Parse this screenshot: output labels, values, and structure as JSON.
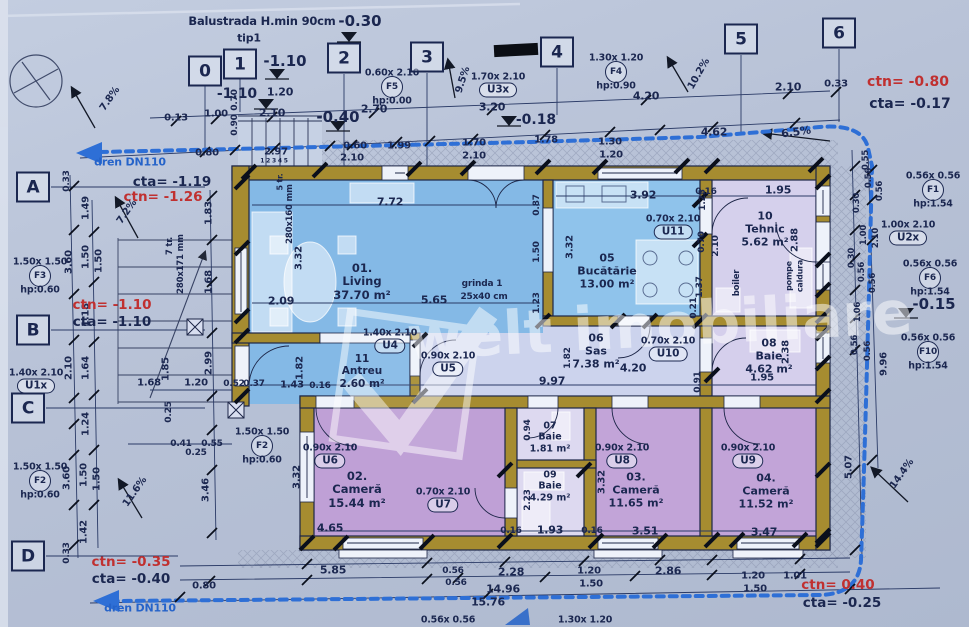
{
  "palette": {
    "ink": "#1b2750",
    "red": "#c03030",
    "blue": "#2563c9"
  },
  "watermark": {
    "brand": "welt imobiliare"
  },
  "grid": {
    "cols": [
      {
        "n": "0",
        "x": 205,
        "y": 71
      },
      {
        "n": "1",
        "x": 240,
        "y": 64
      },
      {
        "n": "2",
        "x": 344,
        "y": 58
      },
      {
        "n": "3",
        "x": 427,
        "y": 57
      },
      {
        "n": "4",
        "x": 557,
        "y": 52
      },
      {
        "n": "5",
        "x": 741,
        "y": 39
      },
      {
        "n": "6",
        "x": 839,
        "y": 33
      }
    ],
    "rows": [
      {
        "n": "A",
        "x": 33,
        "y": 187
      },
      {
        "n": "B",
        "x": 33,
        "y": 330
      },
      {
        "n": "C",
        "x": 28,
        "y": 408
      },
      {
        "n": "D",
        "x": 28,
        "y": 556
      }
    ]
  },
  "rooms": [
    {
      "num": "01.",
      "name": "Living",
      "area": "37.70 m²",
      "cx": 362,
      "cy": 281,
      "s": 11.5
    },
    {
      "num": "05",
      "name": "Bucătărie",
      "area": "13.00 m²",
      "cx": 607,
      "cy": 271,
      "s": 11
    },
    {
      "num": "10",
      "name": "Tehnic",
      "area": "5.62 m²",
      "cx": 765,
      "cy": 229,
      "s": 11
    },
    {
      "num": "06",
      "name": "Sas",
      "area": "7.38 m²",
      "cx": 596,
      "cy": 351,
      "s": 11
    },
    {
      "num": "08",
      "name": "Baie",
      "area": "4.62 m²",
      "cx": 769,
      "cy": 356,
      "s": 11
    },
    {
      "num": "11",
      "name": "Antreu",
      "area": "2.60 m²",
      "cx": 362,
      "cy": 371,
      "s": 10.5
    },
    {
      "num": "02.",
      "name": "Cameră",
      "area": "15.44 m²",
      "cx": 357,
      "cy": 489,
      "s": 11.5
    },
    {
      "num": "03.",
      "name": "Cameră",
      "area": "11.65 m²",
      "cx": 636,
      "cy": 490,
      "s": 11
    },
    {
      "num": "04.",
      "name": "Cameră",
      "area": "11.52 m²",
      "cx": 766,
      "cy": 491,
      "s": 11
    },
    {
      "num": "07",
      "name": "Baie",
      "area": "1.81 m²",
      "cx": 550,
      "cy": 437,
      "s": 9.5
    },
    {
      "num": "09",
      "name": "Baie",
      "area": "4.29 m²",
      "cx": 550,
      "cy": 486,
      "s": 9.5
    }
  ],
  "doors": [
    {
      "id": "U1x",
      "size": "1.40x 2.10",
      "x": 36,
      "y": 386
    },
    {
      "id": "U2x",
      "size": "1.00x 2.10",
      "x": 908,
      "y": 238
    },
    {
      "id": "U3x",
      "size": "1.70x 2.10",
      "x": 498,
      "y": 90
    },
    {
      "id": "U4",
      "size": "1.40x 2.10",
      "x": 390,
      "y": 346
    },
    {
      "id": "U5",
      "size": "0.90x 2.10",
      "x": 448,
      "y": 369
    },
    {
      "id": "U6",
      "size": "0.90x 2.10",
      "x": 330,
      "y": 461
    },
    {
      "id": "U7",
      "size": "0.70x 2.10",
      "x": 443,
      "y": 505
    },
    {
      "id": "U8",
      "size": "0.90x 2.10",
      "x": 622,
      "y": 461
    },
    {
      "id": "U9",
      "size": "0.90x 2.10",
      "x": 748,
      "y": 461
    },
    {
      "id": "U10",
      "size": "0.70x 2.10",
      "x": 668,
      "y": 354
    },
    {
      "id": "U11",
      "size": "0.70x 2.10",
      "x": 673,
      "y": 232
    }
  ],
  "windows": [
    {
      "id": "F1",
      "size": "0.56x 0.56",
      "hp": "hp:1.54",
      "x": 933,
      "y": 190
    },
    {
      "id": "F2",
      "size": "1.50x 1.50",
      "hp": "hp:0.60",
      "x": 40,
      "y": 481
    },
    {
      "id": "F2",
      "size": "1.50x 1.50",
      "hp": "hp:0.60",
      "x": 262,
      "y": 446
    },
    {
      "id": "F3",
      "size": "1.50x 1.50",
      "hp": "hp:0.60",
      "x": 40,
      "y": 276
    },
    {
      "id": "F4",
      "size": "1.30x 1.20",
      "hp": "hp:0.90",
      "x": 616,
      "y": 72
    },
    {
      "id": "F5",
      "size": "0.60x 2.10",
      "hp": "hp:0.00",
      "x": 392,
      "y": 87
    },
    {
      "id": "F6",
      "size": "0.56x 0.56",
      "hp": "hp:1.54",
      "x": 930,
      "y": 278
    },
    {
      "id": "F10",
      "size": "0.56x 0.56",
      "hp": "hp:1.54",
      "x": 928,
      "y": 352
    }
  ],
  "annotations": {
    "levels": [
      {
        "t": "-0.30",
        "x": 360,
        "y": 21,
        "s": 15
      },
      {
        "t": "-1.10",
        "x": 285,
        "y": 61,
        "s": 15
      },
      {
        "t": "-1.10",
        "x": 237,
        "y": 94,
        "s": 14
      },
      {
        "t": "-0.40",
        "x": 338,
        "y": 117,
        "s": 15
      },
      {
        "t": "-0.18",
        "x": 536,
        "y": 120,
        "s": 14
      },
      {
        "t": "-0.15",
        "x": 934,
        "y": 304,
        "s": 15
      },
      {
        "t": "cta= -1.19",
        "x": 172,
        "y": 182,
        "s": 13.5
      },
      {
        "t": "ctn= -1.26",
        "x": 163,
        "y": 197,
        "s": 13.5,
        "c": "red"
      },
      {
        "t": "ctn= -1.10",
        "x": 112,
        "y": 305,
        "s": 13.5,
        "c": "red"
      },
      {
        "t": "cta= -1.10",
        "x": 112,
        "y": 322,
        "s": 13.5
      },
      {
        "t": "ctn= -0.35",
        "x": 131,
        "y": 562,
        "s": 13.5,
        "c": "red"
      },
      {
        "t": "cta= -0.40",
        "x": 131,
        "y": 579,
        "s": 13.5
      },
      {
        "t": "ctn= -0.80",
        "x": 908,
        "y": 82,
        "s": 14,
        "c": "red"
      },
      {
        "t": "cta= -0.17",
        "x": 910,
        "y": 104,
        "s": 14
      },
      {
        "t": "ctn= 0.40",
        "x": 838,
        "y": 585,
        "s": 13.5,
        "c": "red"
      },
      {
        "t": "cta= -0.25",
        "x": 842,
        "y": 603,
        "s": 13.5
      }
    ],
    "slopes": [
      {
        "t": "7.8%",
        "x": 110,
        "y": 99,
        "r": -55
      },
      {
        "t": "7.2%",
        "x": 127,
        "y": 212,
        "r": -55
      },
      {
        "t": "11.6%",
        "x": 135,
        "y": 492,
        "r": -55
      },
      {
        "t": "9.5%",
        "x": 463,
        "y": 80,
        "r": -72
      },
      {
        "t": "10.2%",
        "x": 699,
        "y": 74,
        "r": -60
      },
      {
        "t": "6.5%",
        "x": 796,
        "y": 132,
        "r": -8,
        "s": 11
      },
      {
        "t": "14.4%",
        "x": 902,
        "y": 474,
        "r": -55
      }
    ],
    "notes": [
      {
        "t": "Balustrada H.min 90cm",
        "x": 262,
        "y": 21,
        "s": 11.5
      },
      {
        "t": "tip1",
        "x": 249,
        "y": 38,
        "s": 11
      },
      {
        "t": "dren DN110",
        "x": 130,
        "y": 162,
        "s": 11,
        "c": "blue"
      },
      {
        "t": "dren DN110",
        "x": 140,
        "y": 608,
        "s": 11,
        "c": "blue"
      },
      {
        "t": "grinda 1",
        "x": 482,
        "y": 284,
        "s": 9
      },
      {
        "t": "25x40 cm",
        "x": 484,
        "y": 297,
        "s": 9
      },
      {
        "t": "boiler",
        "x": 737,
        "y": 283,
        "r": -90,
        "s": 8.5
      },
      {
        "t": "pompe",
        "x": 789,
        "y": 276,
        "r": -90,
        "s": 8
      },
      {
        "t": "caldura",
        "x": 800,
        "y": 276,
        "r": -90,
        "s": 8
      },
      {
        "t": "5 tr.",
        "x": 280,
        "y": 182,
        "r": -90,
        "s": 8
      },
      {
        "t": "280x160 mm",
        "x": 290,
        "y": 214,
        "r": -90,
        "s": 8.5
      },
      {
        "t": "7 tr.",
        "x": 170,
        "y": 246,
        "r": -90,
        "s": 8.5
      },
      {
        "t": "280x171 mm",
        "x": 181,
        "y": 264,
        "r": -90,
        "s": 8.5
      },
      {
        "t": "1 2 3 4 5",
        "x": 274,
        "y": 161,
        "s": 6
      }
    ],
    "dims": [
      {
        "t": "0.13",
        "x": 176,
        "y": 118
      },
      {
        "t": "1.00",
        "x": 216,
        "y": 114
      },
      {
        "t": "1.20",
        "x": 280,
        "y": 92,
        "s": 11
      },
      {
        "t": "2.10",
        "x": 272,
        "y": 113,
        "s": 11
      },
      {
        "t": "2.70",
        "x": 374,
        "y": 109,
        "s": 11
      },
      {
        "t": "0.80",
        "x": 207,
        "y": 153
      },
      {
        "t": "2.97",
        "x": 276,
        "y": 152
      },
      {
        "t": "0.60",
        "x": 355,
        "y": 146
      },
      {
        "t": "2.10",
        "x": 352,
        "y": 158
      },
      {
        "t": "1.99",
        "x": 399,
        "y": 146
      },
      {
        "t": "1.70",
        "x": 474,
        "y": 143
      },
      {
        "t": "2.10",
        "x": 474,
        "y": 156
      },
      {
        "t": "1.78",
        "x": 546,
        "y": 140
      },
      {
        "t": "1.30",
        "x": 610,
        "y": 142
      },
      {
        "t": "1.20",
        "x": 611,
        "y": 155
      },
      {
        "t": "4.62",
        "x": 714,
        "y": 132,
        "s": 11
      },
      {
        "t": "3.20",
        "x": 492,
        "y": 107,
        "s": 11
      },
      {
        "t": "4.20",
        "x": 646,
        "y": 96,
        "s": 11
      },
      {
        "t": "2.10",
        "x": 788,
        "y": 87,
        "s": 11
      },
      {
        "t": "0.33",
        "x": 836,
        "y": 84
      },
      {
        "t": "0.70",
        "x": 235,
        "y": 100,
        "r": -90,
        "s": 9
      },
      {
        "t": "0.90",
        "x": 235,
        "y": 125,
        "r": -90,
        "s": 9
      },
      {
        "t": "0.33",
        "x": 67,
        "y": 181,
        "r": -90,
        "s": 9
      },
      {
        "t": "1.49",
        "x": 86,
        "y": 208,
        "r": -90
      },
      {
        "t": "3.60",
        "x": 69,
        "y": 262,
        "r": -90
      },
      {
        "t": "1.50",
        "x": 86,
        "y": 257,
        "r": -90
      },
      {
        "t": "1.50",
        "x": 99,
        "y": 261,
        "r": -90
      },
      {
        "t": "1.18",
        "x": 86,
        "y": 315,
        "r": -90
      },
      {
        "t": "2.10",
        "x": 69,
        "y": 368,
        "r": -90
      },
      {
        "t": "1.64",
        "x": 86,
        "y": 368,
        "r": -90
      },
      {
        "t": "1.24",
        "x": 86,
        "y": 424,
        "r": -90
      },
      {
        "t": "3.60",
        "x": 67,
        "y": 478,
        "r": -90
      },
      {
        "t": "1.50",
        "x": 84,
        "y": 475,
        "r": -90
      },
      {
        "t": "1.50",
        "x": 97,
        "y": 479,
        "r": -90
      },
      {
        "t": "1.42",
        "x": 84,
        "y": 532,
        "r": -90
      },
      {
        "t": "0.33",
        "x": 67,
        "y": 553,
        "r": -90,
        "s": 9
      },
      {
        "t": "1.83",
        "x": 209,
        "y": 213,
        "r": -90
      },
      {
        "t": "1.68",
        "x": 209,
        "y": 282,
        "r": -90
      },
      {
        "t": "1.85",
        "x": 166,
        "y": 369,
        "r": -90
      },
      {
        "t": "2.99",
        "x": 209,
        "y": 363,
        "r": -90
      },
      {
        "t": "1.68",
        "x": 149,
        "y": 383
      },
      {
        "t": "1.20",
        "x": 196,
        "y": 383
      },
      {
        "t": "0.52",
        "x": 234,
        "y": 384,
        "s": 9
      },
      {
        "t": "0.37",
        "x": 254,
        "y": 384,
        "s": 9
      },
      {
        "t": "1.43",
        "x": 292,
        "y": 385
      },
      {
        "t": "0.16",
        "x": 320,
        "y": 386,
        "s": 9
      },
      {
        "t": "1.82",
        "x": 300,
        "y": 368,
        "r": -90
      },
      {
        "t": "0.25",
        "x": 169,
        "y": 412,
        "r": -90,
        "s": 9
      },
      {
        "t": "0.41",
        "x": 181,
        "y": 444,
        "s": 9
      },
      {
        "t": "0.55",
        "x": 212,
        "y": 444,
        "s": 9
      },
      {
        "t": "0.25",
        "x": 196,
        "y": 453,
        "s": 9
      },
      {
        "t": "3.46",
        "x": 206,
        "y": 490,
        "r": -90
      },
      {
        "t": "7.72",
        "x": 390,
        "y": 202,
        "s": 11
      },
      {
        "t": "3.32",
        "x": 299,
        "y": 258,
        "r": -90
      },
      {
        "t": "2.09",
        "x": 281,
        "y": 301,
        "s": 11
      },
      {
        "t": "5.65",
        "x": 434,
        "y": 300,
        "s": 11
      },
      {
        "t": "9.97",
        "x": 552,
        "y": 381,
        "s": 11
      },
      {
        "t": "0.87",
        "x": 537,
        "y": 205,
        "r": -90,
        "s": 9
      },
      {
        "t": "1.50",
        "x": 537,
        "y": 252,
        "r": -90,
        "s": 9
      },
      {
        "t": "1.23",
        "x": 537,
        "y": 303,
        "r": -90,
        "s": 9
      },
      {
        "t": "3.32",
        "x": 570,
        "y": 247,
        "r": -90
      },
      {
        "t": "3.92",
        "x": 643,
        "y": 195,
        "s": 11
      },
      {
        "t": "0.16",
        "x": 706,
        "y": 192,
        "s": 9
      },
      {
        "t": "1.95",
        "x": 778,
        "y": 190,
        "s": 11
      },
      {
        "t": "1.25",
        "x": 703,
        "y": 200,
        "r": -90,
        "s": 9
      },
      {
        "t": "0.70",
        "x": 702,
        "y": 242,
        "r": -90,
        "s": 9
      },
      {
        "t": "2.10",
        "x": 716,
        "y": 246,
        "r": -90,
        "s": 9
      },
      {
        "t": "1.37",
        "x": 700,
        "y": 287,
        "r": -90,
        "s": 9
      },
      {
        "t": "0.21",
        "x": 694,
        "y": 308,
        "r": -90,
        "s": 9
      },
      {
        "t": "2.88",
        "x": 795,
        "y": 240,
        "r": -90
      },
      {
        "t": "4.20",
        "x": 633,
        "y": 368,
        "s": 11
      },
      {
        "t": "0.91",
        "x": 698,
        "y": 382,
        "r": -90,
        "s": 9
      },
      {
        "t": "1.82",
        "x": 568,
        "y": 358,
        "r": -90,
        "s": 9
      },
      {
        "t": "2.38",
        "x": 786,
        "y": 352,
        "r": -90
      },
      {
        "t": "1.95",
        "x": 762,
        "y": 378
      },
      {
        "t": "3.32",
        "x": 297,
        "y": 477,
        "r": -90
      },
      {
        "t": "4.65",
        "x": 330,
        "y": 528,
        "s": 11
      },
      {
        "t": "0.16",
        "x": 511,
        "y": 531,
        "s": 9
      },
      {
        "t": "1.93",
        "x": 550,
        "y": 530,
        "s": 11
      },
      {
        "t": "0.16",
        "x": 592,
        "y": 531,
        "s": 9
      },
      {
        "t": "3.51",
        "x": 645,
        "y": 531,
        "s": 11
      },
      {
        "t": "3.47",
        "x": 764,
        "y": 532,
        "s": 11
      },
      {
        "t": "3.32",
        "x": 602,
        "y": 482,
        "r": -90
      },
      {
        "t": "2.23",
        "x": 528,
        "y": 500,
        "r": -90,
        "s": 9
      },
      {
        "t": "0.94",
        "x": 528,
        "y": 430,
        "r": -90,
        "s": 9
      },
      {
        "t": "5.07",
        "x": 849,
        "y": 467,
        "r": -90
      },
      {
        "t": "9.96",
        "x": 884,
        "y": 364,
        "r": -90
      },
      {
        "t": "0.30",
        "x": 857,
        "y": 203,
        "r": -90,
        "s": 8.5
      },
      {
        "t": "0.55",
        "x": 866,
        "y": 160,
        "r": -90,
        "s": 8.5
      },
      {
        "t": "0.56",
        "x": 869,
        "y": 178,
        "r": -90,
        "s": 8.5
      },
      {
        "t": "0.56",
        "x": 880,
        "y": 191,
        "r": -90,
        "s": 8.5
      },
      {
        "t": "1.00",
        "x": 864,
        "y": 235,
        "r": -90,
        "s": 8.5
      },
      {
        "t": "2.10",
        "x": 876,
        "y": 238,
        "r": -90,
        "s": 8.5
      },
      {
        "t": "0.30",
        "x": 852,
        "y": 258,
        "r": -90,
        "s": 8.5
      },
      {
        "t": "0.56",
        "x": 862,
        "y": 272,
        "r": -90,
        "s": 8.5
      },
      {
        "t": "0.56",
        "x": 873,
        "y": 283,
        "r": -90,
        "s": 8.5
      },
      {
        "t": "1.06",
        "x": 858,
        "y": 312,
        "r": -90,
        "s": 8.5
      },
      {
        "t": "0.56",
        "x": 855,
        "y": 345,
        "r": -90,
        "s": 8.5
      },
      {
        "t": "0.56",
        "x": 868,
        "y": 351,
        "r": -90,
        "s": 8.5
      },
      {
        "t": "0.80",
        "x": 204,
        "y": 586
      },
      {
        "t": "5.85",
        "x": 333,
        "y": 570,
        "s": 11
      },
      {
        "t": "0.56",
        "x": 453,
        "y": 571,
        "s": 9
      },
      {
        "t": "0.56",
        "x": 456,
        "y": 583,
        "s": 9
      },
      {
        "t": "2.28",
        "x": 511,
        "y": 572,
        "s": 11
      },
      {
        "t": "1.20",
        "x": 589,
        "y": 571
      },
      {
        "t": "1.50",
        "x": 591,
        "y": 584
      },
      {
        "t": "2.86",
        "x": 668,
        "y": 571,
        "s": 11
      },
      {
        "t": "1.20",
        "x": 753,
        "y": 576
      },
      {
        "t": "1.50",
        "x": 755,
        "y": 589
      },
      {
        "t": "1.01",
        "x": 795,
        "y": 576
      },
      {
        "t": "14.96",
        "x": 503,
        "y": 589,
        "s": 11
      },
      {
        "t": "15.76",
        "x": 488,
        "y": 602,
        "s": 11
      },
      {
        "t": "0.56x 0.56",
        "x": 448,
        "y": 620,
        "s": 9.5
      },
      {
        "t": "1.30x 1.20",
        "x": 585,
        "y": 620,
        "s": 9.5
      }
    ]
  }
}
